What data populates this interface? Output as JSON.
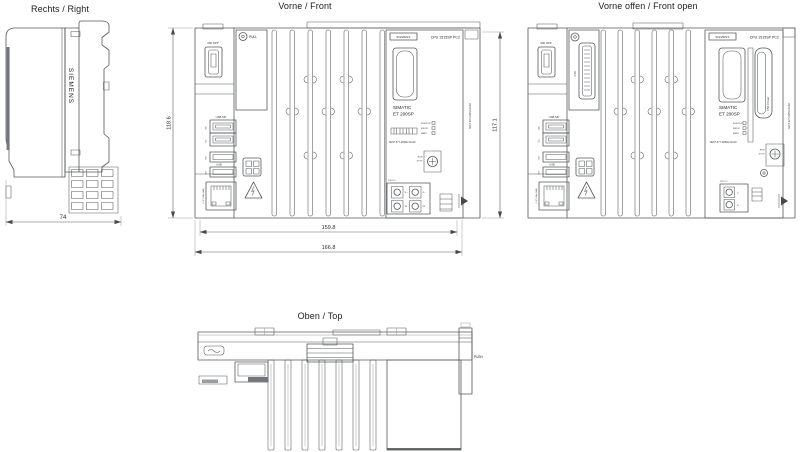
{
  "page": {
    "background": "#ffffff"
  },
  "views": {
    "right": {
      "title": "Rechts / Right",
      "brand_vertical": "SIEMENS",
      "dim_depth": "74"
    },
    "front": {
      "title": "Vorne / Front",
      "dims": {
        "height_left": "118.6",
        "height_right": "117.1",
        "width_inner": "159.8",
        "width_outer": "166.8"
      },
      "labels": {
        "dp_port": "X80 DPP",
        "pull": "PULL",
        "usb_top_group": "USB MP",
        "usb_bottom_group": "USB",
        "usb_ports": [
          "X60",
          "X61",
          "X62",
          "X63"
        ],
        "lan_port": "X1 P1 GBit (LAN)",
        "brand": "SIEMENS",
        "cpu_type": "CPU 1515SP PC2",
        "product_line1": "SIMATIC",
        "product_line2": "ET 200SP",
        "leds": [
          "RUN/STOP",
          "ERROR",
          "MAINT"
        ],
        "article_no": "6ES7 677-2DB42-0GA0",
        "mode_switch": [
          "RUN",
          "STOP"
        ],
        "power": "24V DC",
        "terminals": [
          "1L+",
          "1M",
          "2L+",
          "2M"
        ]
      }
    },
    "front_open": {
      "title": "Vorne offen / Front open",
      "labels": {
        "dp_port": "X80 DPP",
        "x30": "X30",
        "usb_top_group": "USB MP",
        "usb_bottom_group": "USB",
        "usb_ports": [
          "X60",
          "X61",
          "X62",
          "X63"
        ],
        "lan_port": "X1 P1 GBit (LAN)",
        "brand": "SIEMENS",
        "cpu_type": "CPU 1515SP PC2",
        "product_line1": "SIMATIC",
        "product_line2": "ET 200SP",
        "cfast": "X50  CFast",
        "leds": [
          "RUN/STOP",
          "ERROR",
          "MAINT"
        ],
        "article_no": "6ES7 677-2DB42-0GA0",
        "mode_switch": [
          "RUN",
          "STOP"
        ],
        "power": "24V DC",
        "terminals": [
          "L+",
          "M"
        ]
      }
    },
    "top": {
      "title": "Oben / Top",
      "push": "PUSH"
    }
  }
}
